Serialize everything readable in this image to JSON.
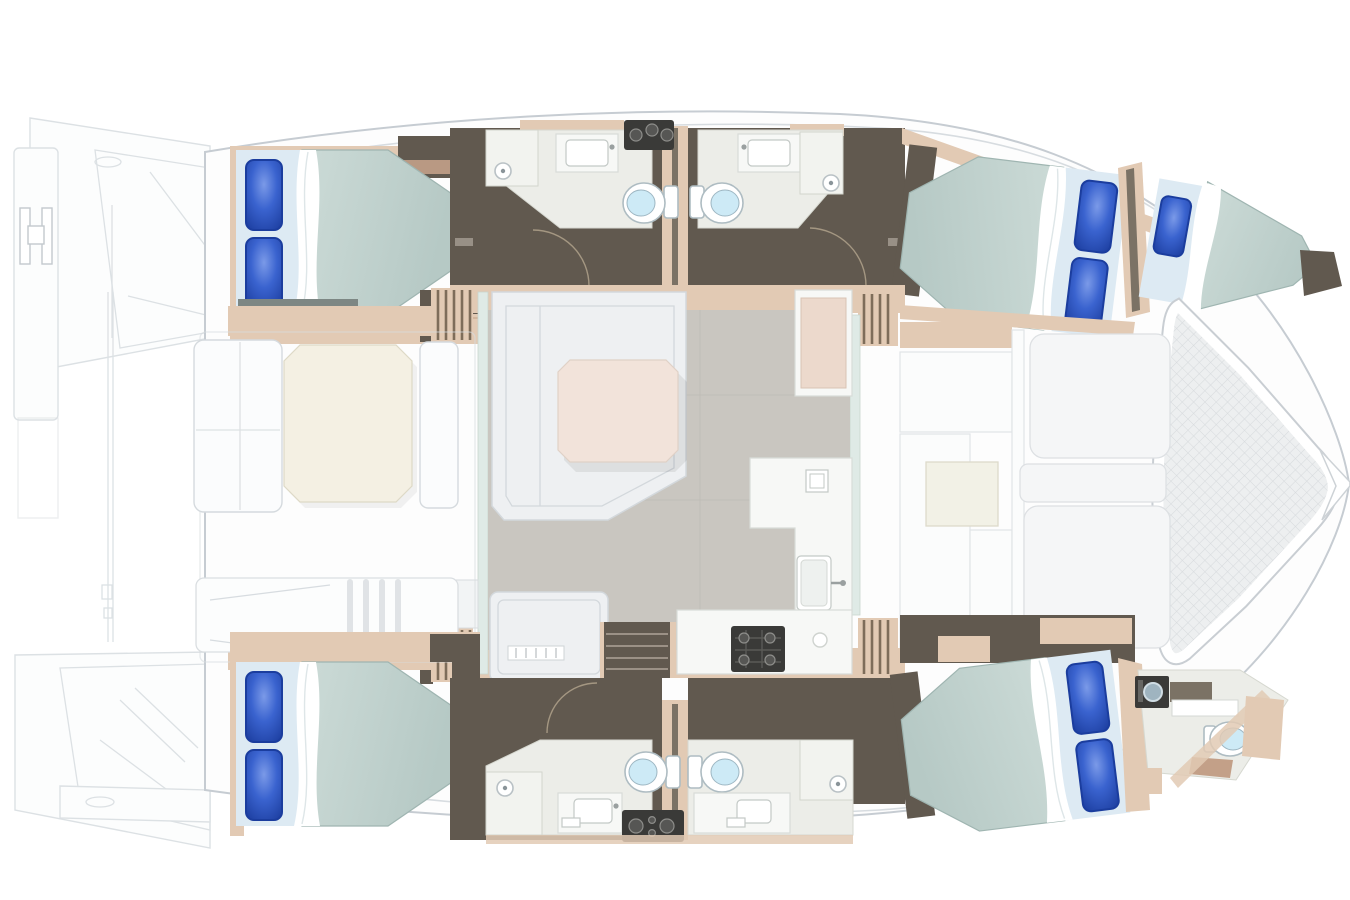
{
  "page": {
    "background": "#ffffff",
    "description": "Top-down interior floor plan of a sailing catamaran, bow to the right"
  },
  "colors": {
    "page_bg": "#ffffff",
    "deck": "#fdfdfd",
    "deck_stroke": "#c6ccd2",
    "faint": "#d7dce0",
    "walnut": "#61594f",
    "walnut_light": "#7b7265",
    "trim_tan": "#e2cab4",
    "trim_tan_dark": "#c3a088",
    "mattress": "#c3d4d0",
    "mattress_edge": "#9fb5b1",
    "bed_head": "#ddeaf3",
    "pillow": "#2e57c5",
    "pillow_dark": "#1b3d9e",
    "sheet": "#ffffff",
    "bath_floor": "#ecede8",
    "shower": "#f2f3ef",
    "toilet_bowl": "#cdeaf6",
    "salon_floor": "#c9c6c0",
    "sofa": "#eef0f2",
    "sofa_stroke": "#d3d8dc",
    "table_salon": "#f2e3da",
    "table_cockpit": "#f4f0e3",
    "counter": "#f7f8f6",
    "appliance_dark": "#3a3a38",
    "mesh_bg": "#edeff0",
    "mesh_line": "#d7dadd",
    "glass": "#dfeae6"
  },
  "boat": {
    "view": "overhead floor plan",
    "bow": "right",
    "stern": "left",
    "areas": [
      {
        "name": "aft-swim-platforms"
      },
      {
        "name": "aft-cockpit"
      },
      {
        "name": "salon"
      },
      {
        "name": "galley"
      },
      {
        "name": "foredeck"
      },
      {
        "name": "bow-trampoline"
      }
    ],
    "cabins": [
      {
        "name": "port-aft-cabin",
        "berth": "double",
        "pillows": 2
      },
      {
        "name": "port-forward-cabin",
        "berth": "double",
        "pillows": 2
      },
      {
        "name": "port-bow-berth",
        "berth": "single",
        "pillows": 1
      },
      {
        "name": "starboard-aft-cabin",
        "berth": "double",
        "pillows": 2
      },
      {
        "name": "starboard-forward-cabin",
        "berth": "double",
        "pillows": 2
      }
    ],
    "heads": [
      {
        "name": "port-aft-head",
        "fixtures": [
          "toilet",
          "sink",
          "shower"
        ]
      },
      {
        "name": "port-forward-head",
        "fixtures": [
          "toilet",
          "sink",
          "shower"
        ]
      },
      {
        "name": "starboard-aft-head",
        "fixtures": [
          "toilet",
          "sink",
          "shower"
        ]
      },
      {
        "name": "starboard-forward-head",
        "fixtures": [
          "toilet",
          "sink",
          "shower"
        ]
      },
      {
        "name": "starboard-bow-head",
        "fixtures": [
          "toilet",
          "sink",
          "washer"
        ]
      }
    ],
    "counts": {
      "double_berths": 4,
      "single_berths": 1,
      "pillows": 9,
      "toilets": 5,
      "companionway_stairs": 2,
      "tables": 2,
      "sunpads": 2
    }
  }
}
